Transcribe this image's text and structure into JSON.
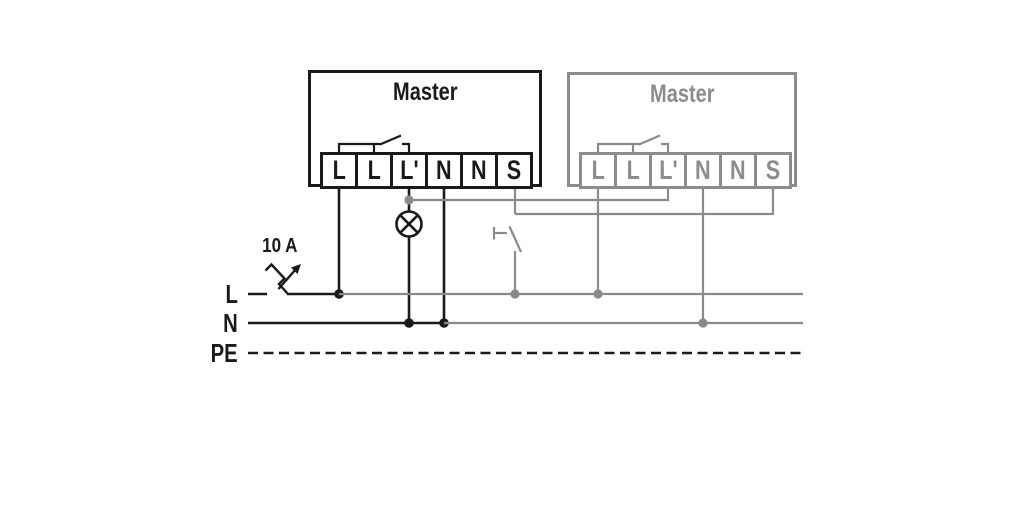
{
  "masters": [
    {
      "title": "Master",
      "terminals": [
        "L",
        "L",
        "L'",
        "N",
        "N",
        "S"
      ],
      "color": "#1a1a1a"
    },
    {
      "title": "Master",
      "terminals": [
        "L",
        "L",
        "L'",
        "N",
        "N",
        "S"
      ],
      "color": "#8c8c8c"
    }
  ],
  "breaker": {
    "rating": "10 A"
  },
  "bus": {
    "l": "L",
    "n": "N",
    "pe": "PE"
  },
  "icons": {
    "lamp": "circle-with-x",
    "push_button": "momentary-contact",
    "circuit_breaker": "zigzag-blade-with-arrow"
  },
  "colors": {
    "black": "#1a1a1a",
    "gray": "#8a8a8a",
    "background": "#ffffff"
  }
}
